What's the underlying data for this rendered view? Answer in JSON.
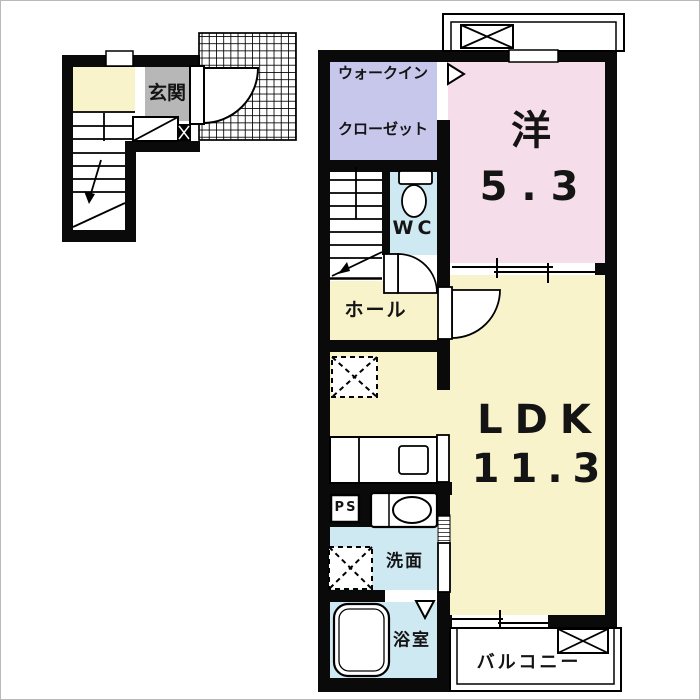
{
  "rooms": {
    "entrance": {
      "label": "玄関"
    },
    "walk_in_closet": {
      "line1": "ウォークイン",
      "line2": "クローゼット"
    },
    "western_room": {
      "label": "洋",
      "area": "5.3"
    },
    "wc": {
      "label": "WC"
    },
    "hall": {
      "label": "ホール"
    },
    "ldk": {
      "label": "LDK",
      "area": "11.3"
    },
    "pipe_space": {
      "label": "PS"
    },
    "washroom": {
      "label": "洗面"
    },
    "bathroom": {
      "label": "浴室"
    },
    "balcony": {
      "label": "バルコニー"
    }
  },
  "colors": {
    "room_cream": "#f8f3cb",
    "room_pink": "#f5dee9",
    "room_lavender": "#c7c7eb",
    "room_blue": "#cfe9f3",
    "room_gray": "#b7b7b7",
    "wall": "#0a0a0a",
    "background": "#ffffff"
  }
}
